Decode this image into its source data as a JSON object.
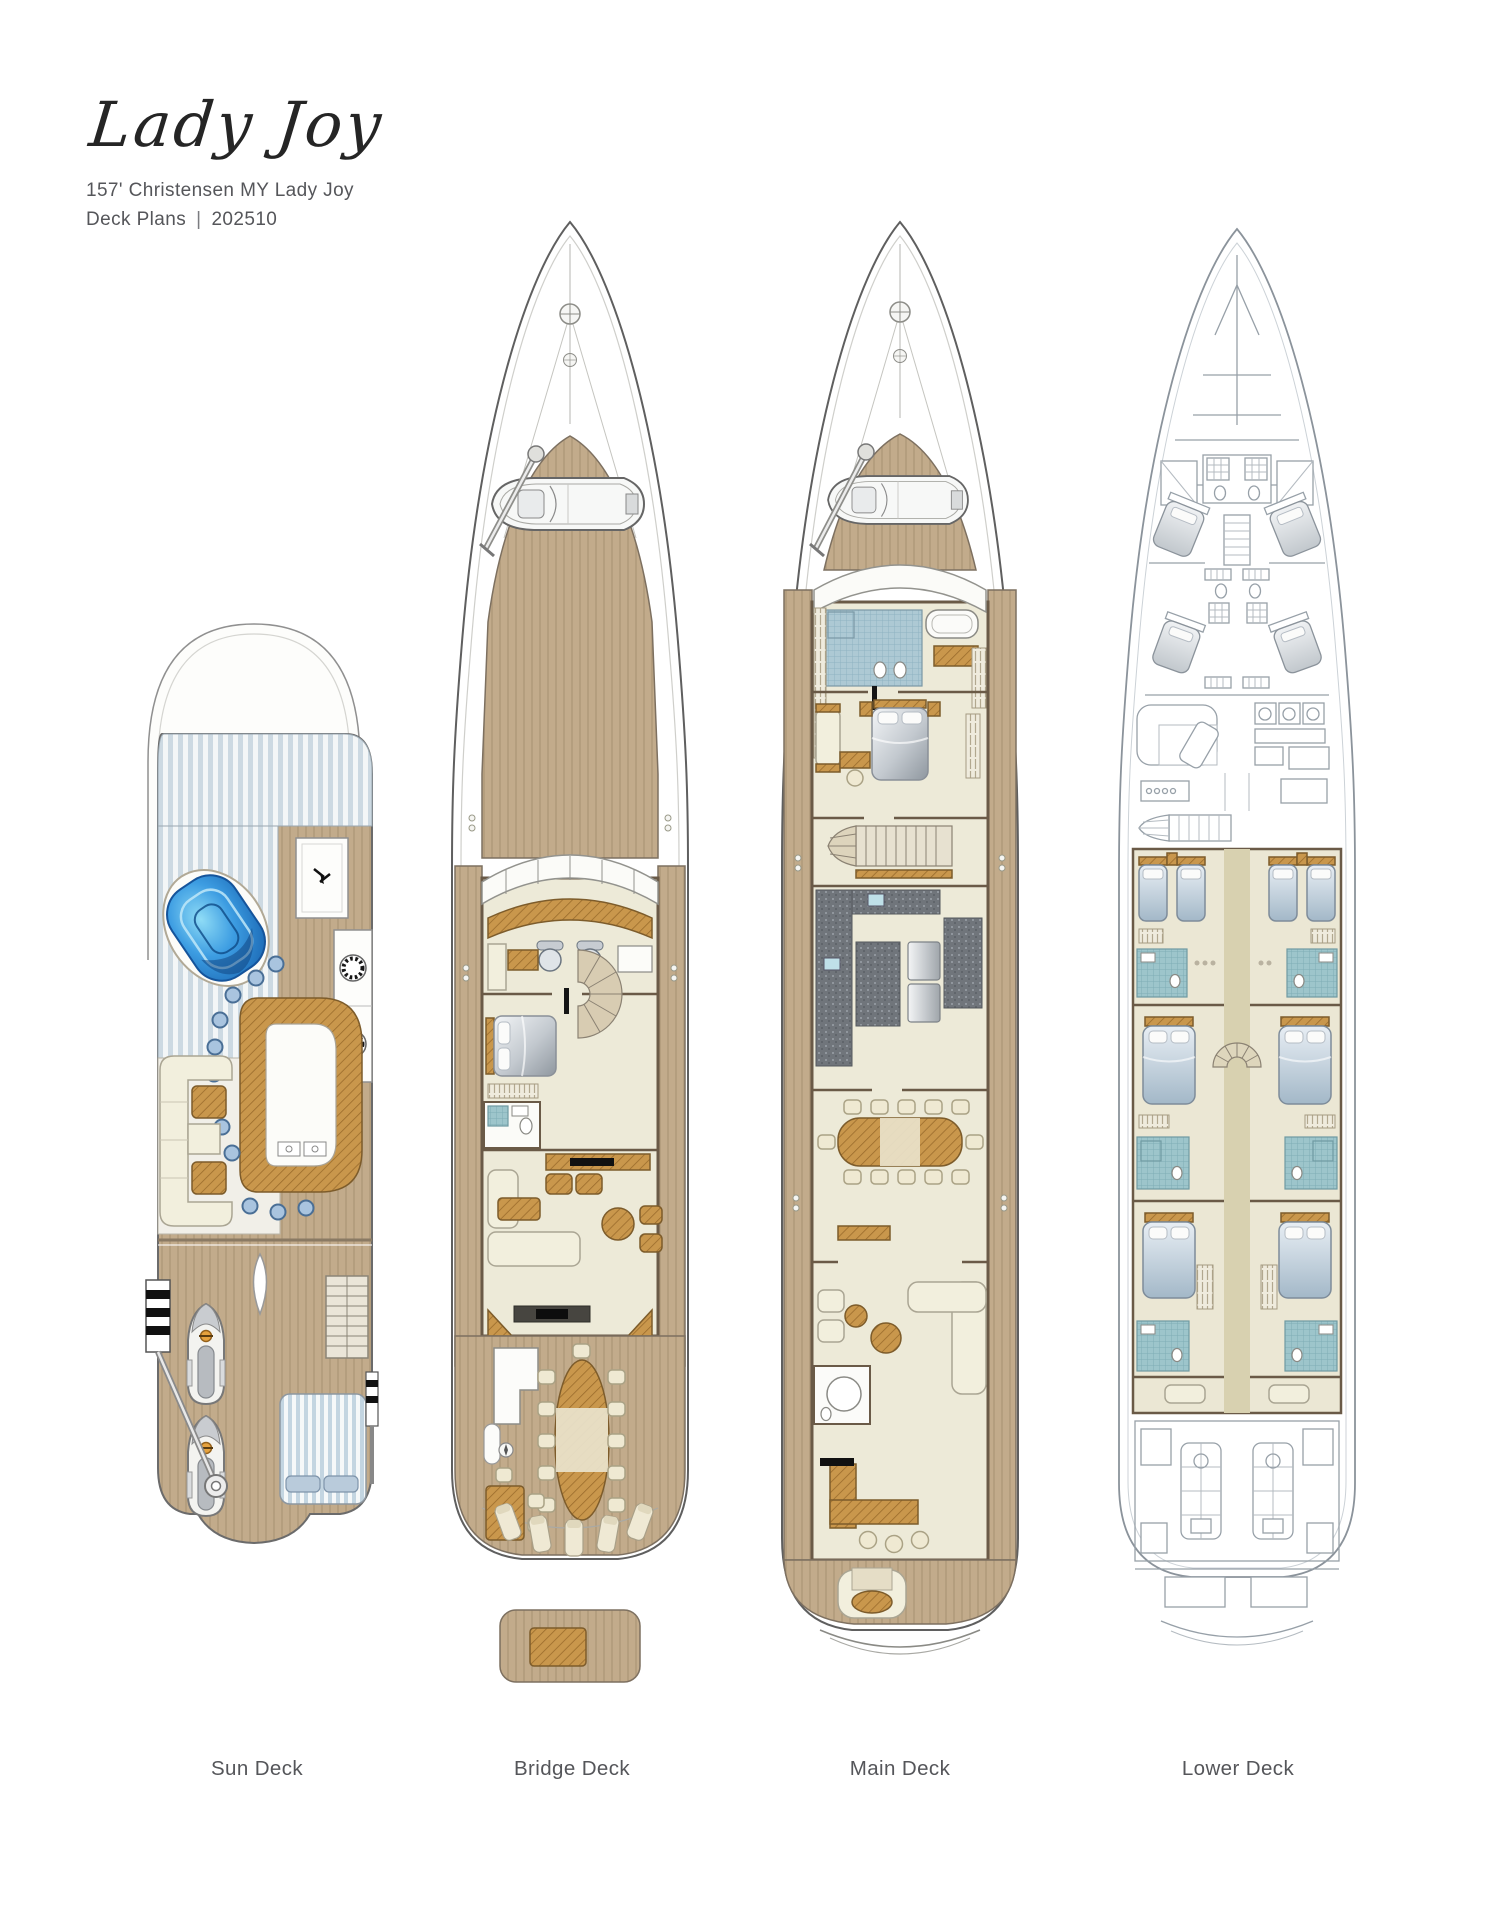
{
  "header": {
    "title": "Lady Joy",
    "subtitle_line1": "157' Christensen MY Lady Joy",
    "subtitle_line2": {
      "label": "Deck Plans",
      "separator": "|",
      "value": "202510"
    }
  },
  "decks": [
    {
      "id": "sun-deck",
      "label": "Sun Deck"
    },
    {
      "id": "bridge-deck",
      "label": "Bridge Deck"
    },
    {
      "id": "main-deck",
      "label": "Main Deck"
    },
    {
      "id": "lower-deck",
      "label": "Lower Deck"
    }
  ],
  "palette": {
    "teak": "#c2ab8b",
    "furniture_wood": "#c9974c",
    "pool_blue": "#1d77c9",
    "stool_blue": "#a9c4df",
    "mosaic_teal": "#9dc5cb",
    "mosaic_blue": "#adc9d4",
    "floor_cream": "#edead8",
    "lower_deck_linework": "#97a0a8",
    "wall_brown": "#6a5a47",
    "text_gray": "#55565a"
  }
}
